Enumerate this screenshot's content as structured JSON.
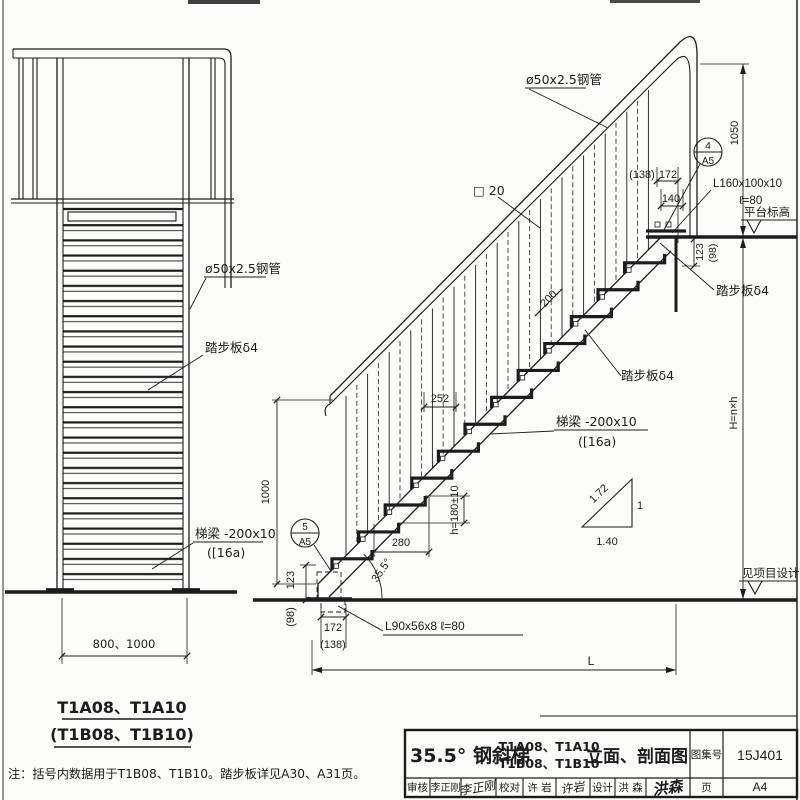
{
  "colors": {
    "ink": "#1c1c1c",
    "paper": "#fcfcfa",
    "dash_gray": "#3a3a3a"
  },
  "front_view": {
    "label_rail_pipe": "ø50x2.5钢管",
    "label_tread": "踏步板δ4",
    "label_stringer_line1": "梯梁 -200x10",
    "label_stringer_line2": "([16a)",
    "dim_width": "800、1000",
    "caption_line1": "T1A08、T1A10",
    "caption_line2": "(T1B08、T1B10)"
  },
  "side_view": {
    "label_rail_pipe": "ø50x2.5钢管",
    "label_baluster": "□ 20",
    "label_tread_mid": "踏步板δ4",
    "label_tread_top": "踏步板δ4",
    "label_stringer_line1": "梯梁 -200x10",
    "label_stringer_line2": "([16a)",
    "label_anchor": "L90x56x8  ℓ=80",
    "label_conn_line1": "L160x100x10",
    "label_conn_line2": "ℓ=80",
    "label_platform_level": "平台标高",
    "label_see_project": "见项目设计",
    "detail_top_no": "4",
    "detail_top_page": "A5",
    "detail_bottom_no": "5",
    "detail_bottom_page": "A5",
    "dim_1000": "1000",
    "dim_123_bottom": "123",
    "dim_98_bottom": "(98)",
    "dim_172_bottom": "172",
    "dim_138_bottom": "(138)",
    "dim_L": "L",
    "dim_angle": "35.5°",
    "dim_280": "280",
    "dim_h": "h=180±10",
    "dim_252": "252",
    "dim_200": "200",
    "dim_138_top": "(138)",
    "dim_172_top": "172",
    "dim_140": "140",
    "dim_1050": "1050",
    "dim_123_top": "123",
    "dim_98_top": "(98)",
    "dim_H": "H=n×h",
    "slope": {
      "hyp": "1.72",
      "rise": "1",
      "run": "1.40"
    }
  },
  "note": "注：括号内数据用于T1B08、T1B10。踏步板详见A30、A31页。",
  "title_block": {
    "title_main": "35.5° 钢斜梯",
    "models_line1": "T1A08、T1A10",
    "models_line2": "T1B08、T1B10",
    "view_name": "立面、剖面图",
    "atlas_label": "图集号",
    "atlas_no": "15J401",
    "page_label": "页",
    "page_no": "A4",
    "reviewer_label": "审核",
    "reviewer_name": "李正刚",
    "reviewer_sig": "李正刚",
    "checker_label": "校对",
    "checker_name": "许 岩",
    "checker_sig": "许岩",
    "designer_label": "设计",
    "designer_name": "洪 森",
    "designer_sig": "洪森"
  }
}
